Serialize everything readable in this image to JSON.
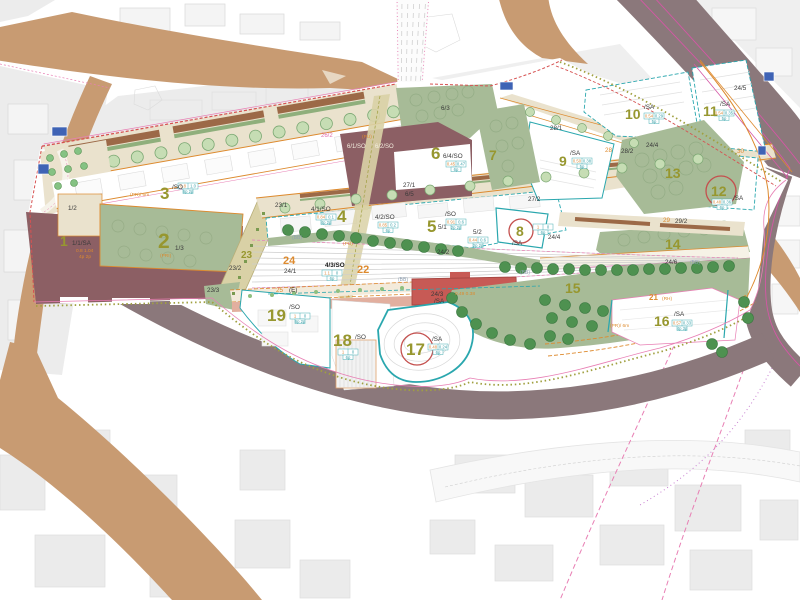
{
  "palette": {
    "road_tan": "#C89B72",
    "road_taupe": "#8B787B",
    "plan_beige": "#EAE2CD",
    "khaki": "#D9D1A6",
    "green_parcel": "#A7BB97",
    "tree_dark": "#4E9150",
    "tree_light": "#C6DDB4",
    "maroon": "#8C5F64",
    "red_building": "#C75A55",
    "salmon": "#E2AF9F",
    "teal": "#2AA7AE",
    "pink": "#E87FB4",
    "magenta": "#D457A5",
    "red_dash": "#D65252",
    "orange": "#DD8A2E",
    "olive_text": "#97972F",
    "context_gray": "#ECECEC",
    "rail_gray": "#CDCDCD",
    "blue_marker": "#3F63B5"
  },
  "labels": [
    {
      "t": "1",
      "x": 60,
      "y": 246,
      "c": "n2"
    },
    {
      "t": "1/1/SA",
      "x": 72,
      "y": 245,
      "c": "sb"
    },
    {
      "t": "0.8 1.04",
      "x": 76,
      "y": 252,
      "c": "to"
    },
    {
      "t": "4p 2p",
      "x": 79,
      "y": 258,
      "c": "to"
    },
    {
      "t": "1/2",
      "x": 68,
      "y": 210,
      "c": "sb"
    },
    {
      "t": "2",
      "x": 158,
      "y": 248,
      "c": "n1"
    },
    {
      "t": "1/3",
      "x": 175,
      "y": 250,
      "c": "sb"
    },
    {
      "t": "(PRI)",
      "x": 160,
      "y": 257,
      "c": "to"
    },
    {
      "t": "3",
      "x": 160,
      "y": 199,
      "c": "n1b"
    },
    {
      "t": "/SO",
      "x": 172,
      "y": 189,
      "c": "sb"
    },
    {
      "t": "(PR)/ 6m",
      "x": 130,
      "y": 196,
      "c": "to"
    },
    {
      "t": "23/1",
      "x": 275,
      "y": 207,
      "c": "sb"
    },
    {
      "t": "4/1/SO",
      "x": 311,
      "y": 211,
      "c": "sb"
    },
    {
      "t": "4",
      "x": 337,
      "y": 222,
      "c": "n1b"
    },
    {
      "t": "4/2/SO",
      "x": 375,
      "y": 219,
      "c": "sb"
    },
    {
      "t": "5",
      "x": 427,
      "y": 232,
      "c": "n1b"
    },
    {
      "t": "/SO",
      "x": 445,
      "y": 216,
      "c": "sb"
    },
    {
      "t": "5/1",
      "x": 438,
      "y": 229,
      "c": "sb"
    },
    {
      "t": "5/2",
      "x": 473,
      "y": 234,
      "c": "sb"
    },
    {
      "t": "6",
      "x": 431,
      "y": 159,
      "c": "n1b"
    },
    {
      "t": "6/4/SO",
      "x": 443,
      "y": 158,
      "c": "sb"
    },
    {
      "t": "6/1/SO",
      "x": 347,
      "y": 148,
      "c": "tw"
    },
    {
      "t": "6/2/SO",
      "x": 375,
      "y": 148,
      "c": "tw"
    },
    {
      "t": "6/3",
      "x": 441,
      "y": 110,
      "c": "sb"
    },
    {
      "t": "6/5",
      "x": 405,
      "y": 196,
      "c": "sb"
    },
    {
      "t": "27/1",
      "x": 403,
      "y": 187,
      "c": "sb"
    },
    {
      "t": "7",
      "x": 489,
      "y": 160,
      "c": "n2"
    },
    {
      "t": "8",
      "x": 516,
      "y": 236,
      "c": "n2"
    },
    {
      "t": "/SA",
      "x": 512,
      "y": 245,
      "c": "sb"
    },
    {
      "t": "9",
      "x": 559,
      "y": 166,
      "c": "n2"
    },
    {
      "t": "/SA",
      "x": 570,
      "y": 155,
      "c": "sb"
    },
    {
      "t": "10",
      "x": 625,
      "y": 119,
      "c": "n2"
    },
    {
      "t": "/SA",
      "x": 644,
      "y": 109,
      "c": "sb"
    },
    {
      "t": "11",
      "x": 703,
      "y": 116,
      "c": "n2"
    },
    {
      "t": "/SA",
      "x": 720,
      "y": 106,
      "c": "sb"
    },
    {
      "t": "12",
      "x": 711,
      "y": 196,
      "c": "n2"
    },
    {
      "t": "/SA",
      "x": 733,
      "y": 200,
      "c": "sb"
    },
    {
      "t": "13",
      "x": 665,
      "y": 178,
      "c": "n2"
    },
    {
      "t": "14",
      "x": 665,
      "y": 249,
      "c": "n2"
    },
    {
      "t": "15",
      "x": 565,
      "y": 293,
      "c": "n2"
    },
    {
      "t": "16",
      "x": 654,
      "y": 326,
      "c": "n2"
    },
    {
      "t": "/SA",
      "x": 674,
      "y": 316,
      "c": "sb"
    },
    {
      "t": "17",
      "x": 406,
      "y": 355,
      "c": "n1b"
    },
    {
      "t": "/SA",
      "x": 432,
      "y": 341,
      "c": "sb"
    },
    {
      "t": "18",
      "x": 333,
      "y": 346,
      "c": "n1b"
    },
    {
      "t": "/SO",
      "x": 355,
      "y": 339,
      "c": "sb"
    },
    {
      "t": "19",
      "x": 267,
      "y": 321,
      "c": "n1b"
    },
    {
      "t": "/SO",
      "x": 289,
      "y": 309,
      "c": "sb"
    },
    {
      "t": "21",
      "x": 649,
      "y": 300,
      "c": "sob"
    },
    {
      "t": "(RH)",
      "x": 662,
      "y": 300,
      "c": "to"
    },
    {
      "t": "22",
      "x": 357,
      "y": 273,
      "c": "so2"
    },
    {
      "t": "23",
      "x": 241,
      "y": 258,
      "c": "n3"
    },
    {
      "t": "23/2",
      "x": 229,
      "y": 270,
      "c": "sb"
    },
    {
      "t": "23/3",
      "x": 207,
      "y": 292,
      "c": "sb"
    },
    {
      "t": "24",
      "x": 283,
      "y": 264,
      "c": "so2"
    },
    {
      "t": "24/1",
      "x": 284,
      "y": 273,
      "c": "sb"
    },
    {
      "t": "4/3/SO",
      "x": 325,
      "y": 267,
      "c": "skb"
    },
    {
      "t": "24/2",
      "x": 437,
      "y": 254,
      "c": "sb"
    },
    {
      "t": "24/3",
      "x": 431,
      "y": 296,
      "c": "sb"
    },
    {
      "t": "/SA",
      "x": 434,
      "y": 303,
      "c": "sb"
    },
    {
      "t": "0.49 0.38",
      "x": 455,
      "y": 295,
      "c": "to"
    },
    {
      "t": "24/4",
      "x": 548,
      "y": 239,
      "c": "sb"
    },
    {
      "t": "24/4",
      "x": 646,
      "y": 147,
      "c": "sb"
    },
    {
      "t": "24/5",
      "x": 734,
      "y": 90,
      "c": "sb"
    },
    {
      "t": "24/6",
      "x": 665,
      "y": 264,
      "c": "sb"
    },
    {
      "t": "(BB)",
      "x": 690,
      "y": 264,
      "c": "tg"
    },
    {
      "t": "(BB)",
      "x": 292,
      "y": 239,
      "c": "tg"
    },
    {
      "t": "(BB)",
      "x": 398,
      "y": 281,
      "c": "tg"
    },
    {
      "t": "(BB)",
      "x": 520,
      "y": 274,
      "c": "tg"
    },
    {
      "t": "25",
      "x": 276,
      "y": 292,
      "c": "so"
    },
    {
      "t": "(E)",
      "x": 289,
      "y": 292,
      "c": "sb"
    },
    {
      "t": "26/2",
      "x": 321,
      "y": 137,
      "c": "tp"
    },
    {
      "t": "(PU)",
      "x": 362,
      "y": 138,
      "c": "to"
    },
    {
      "t": "(PU)",
      "x": 343,
      "y": 245,
      "c": "to"
    },
    {
      "t": "27/2",
      "x": 528,
      "y": 201,
      "c": "sb"
    },
    {
      "t": "28",
      "x": 605,
      "y": 152,
      "c": "so"
    },
    {
      "t": "28/1",
      "x": 550,
      "y": 130,
      "c": "sb"
    },
    {
      "t": "28/2",
      "x": 621,
      "y": 153,
      "c": "sb"
    },
    {
      "t": "29",
      "x": 663,
      "y": 222,
      "c": "so"
    },
    {
      "t": "29/2",
      "x": 675,
      "y": 223,
      "c": "sb"
    },
    {
      "t": "30",
      "x": 737,
      "y": 153,
      "c": "so"
    },
    {
      "t": "(PR)/ 6m",
      "x": 610,
      "y": 327,
      "c": "to"
    }
  ],
  "circled": [
    {
      "x": 521,
      "y": 231,
      "r": 12
    },
    {
      "x": 721,
      "y": 191,
      "r": 15
    },
    {
      "x": 417,
      "y": 349,
      "r": 16
    }
  ],
  "boxes": [
    {
      "x": 178,
      "y": 183,
      "v1": "0.8",
      "v2": "1.0",
      "v3": "6p 2p"
    },
    {
      "x": 316,
      "y": 214,
      "v1": "0.84",
      "v2": "0.1",
      "v3": "4p 2p"
    },
    {
      "x": 378,
      "y": 222,
      "v1": "0.85",
      "v2": "0.2",
      "v3": "6p"
    },
    {
      "x": 446,
      "y": 219,
      "v1": "0.91",
      "v2": "0.6",
      "v3": "2p 2p"
    },
    {
      "x": 468,
      "y": 237,
      "v1": "0.44",
      "v2": "0.6",
      "v3": "2p 2p"
    },
    {
      "x": 446,
      "y": 161,
      "v1": "0.45",
      "v2": "0.47",
      "v3": "6p"
    },
    {
      "x": 533,
      "y": 224,
      "v1": "1",
      "v2": "0",
      "v3": "6p"
    },
    {
      "x": 572,
      "y": 158,
      "v1": "0.50",
      "v2": "0.38",
      "v3": "5p"
    },
    {
      "x": 644,
      "y": 113,
      "v1": "0.54",
      "v2": "0.29",
      "v3": "5p"
    },
    {
      "x": 714,
      "y": 110,
      "v1": "0.54",
      "v2": "0.35",
      "v3": "5p"
    },
    {
      "x": 712,
      "y": 199,
      "v1": "0.48",
      "v2": "0.36",
      "v3": "6p"
    },
    {
      "x": 672,
      "y": 320,
      "v1": "0.57",
      "v2": "0.33",
      "v3": "4p 3p"
    },
    {
      "x": 428,
      "y": 344,
      "v1": "0.48",
      "v2": "0.24",
      "v3": "6p"
    },
    {
      "x": 338,
      "y": 349,
      "v1": "1",
      "v2": "0",
      "v3": "6p"
    },
    {
      "x": 290,
      "y": 313,
      "v1": "1",
      "v2": "0",
      "v3": "6p 2p"
    },
    {
      "x": 322,
      "y": 270,
      "v1": "1.1",
      "v2": "0",
      "v3": "6p"
    }
  ]
}
